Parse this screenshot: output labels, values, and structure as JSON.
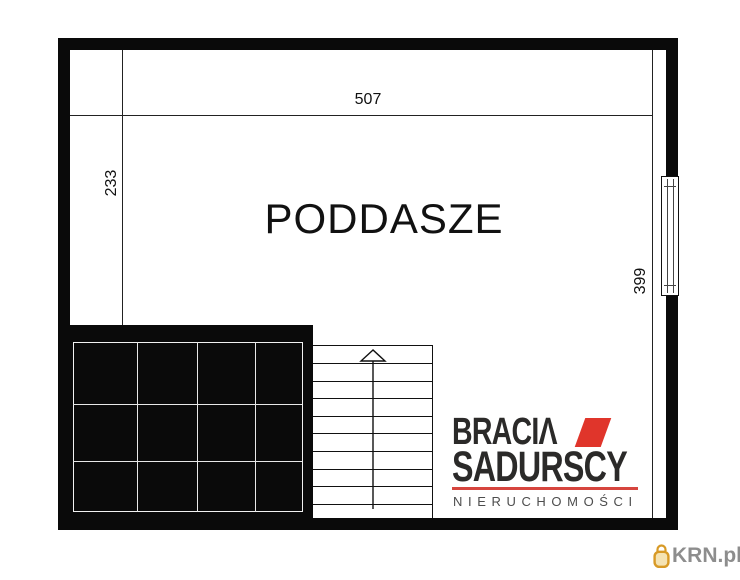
{
  "room": {
    "label": "PODDASZE"
  },
  "dimensions": {
    "top_width": "507",
    "left_height": "233",
    "right_height": "399"
  },
  "stairs": {
    "tread_lines": 9,
    "direction": "up"
  },
  "floor_features": {
    "void_grid": {
      "columns": 4,
      "rows": 3
    },
    "window_side": "right"
  },
  "logo": {
    "line1_main": "BRACI",
    "line1_accent": "Λ",
    "line2": "SADURSCY",
    "line3": "NIERUCHOMOŚCI",
    "accent_color": "#e0352b",
    "rule_color": "#d6453e",
    "text_color": "#2b2a29",
    "line3_color": "#4d4d4d"
  },
  "watermark": {
    "text": "KRN.pl",
    "icon": "padlock-icon",
    "icon_color": "#d89a26",
    "icon_fill": "#f5e3b3",
    "text_color": "#8d8d8d"
  }
}
